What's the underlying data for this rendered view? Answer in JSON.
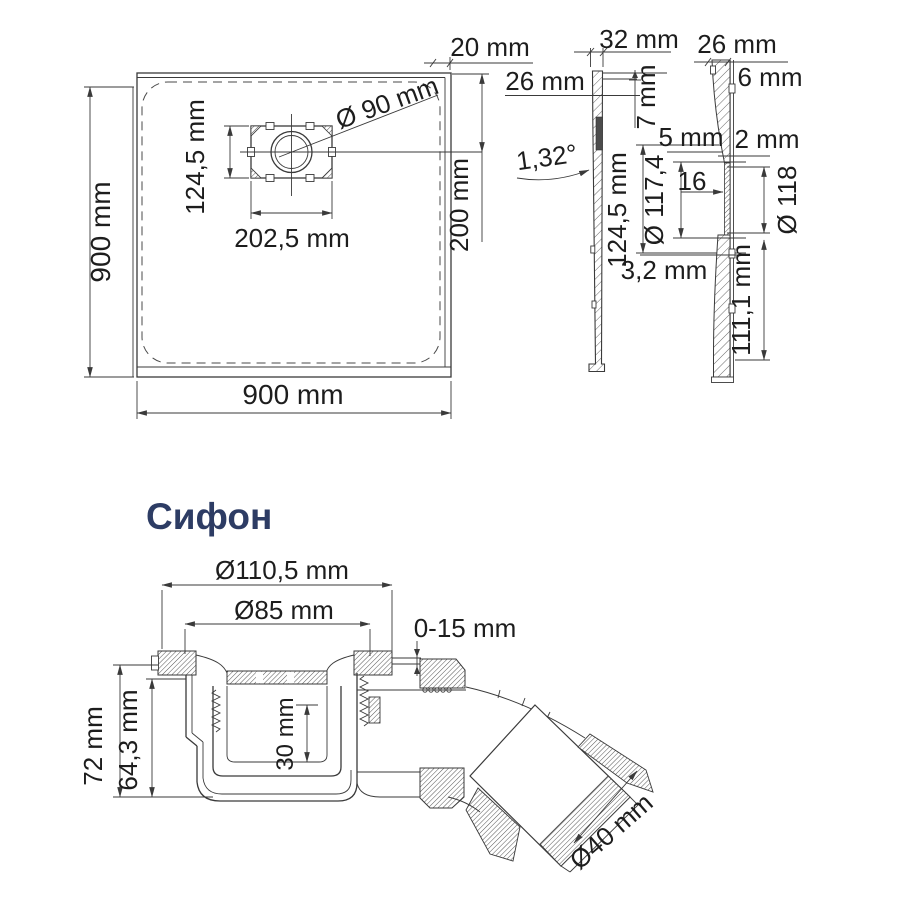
{
  "colors": {
    "line": "#3a3a3a",
    "text": "#1d1d1d",
    "title": "#2d3c64",
    "background": "#ffffff"
  },
  "tray_top_view": {
    "side_left": "900 mm",
    "side_bottom": "900 mm",
    "drain_box_width": "202,5 mm",
    "drain_box_height": "124,5 mm",
    "drain_diameter": "Ø 90 mm",
    "drain_center_offset": "200 mm",
    "edge_width": "20 mm"
  },
  "section_side": {
    "top_width": "32 mm",
    "rim": "26 mm",
    "lip_height": "7 mm",
    "slope_angle": "1,32°",
    "recess_height": "124,5 mm"
  },
  "section_front": {
    "top_width": "26 mm",
    "edge_thickness": "6 mm",
    "wall": "5 mm",
    "gap": "2 mm",
    "inner_diameter": "Ø 117,4",
    "step": "16",
    "outer_diameter": "Ø 118",
    "lip": "3,2 mm",
    "depth": "111,1 mm"
  },
  "siphon": {
    "title": "Сифон",
    "flange_diameter": "Ø110,5 mm",
    "grate_diameter": "Ø85 mm",
    "adjustment": "0-15 mm",
    "height_total": "72 mm",
    "height_body": "64,3 mm",
    "cup_depth": "30 mm",
    "outlet_diameter": "Ø40 mm"
  }
}
